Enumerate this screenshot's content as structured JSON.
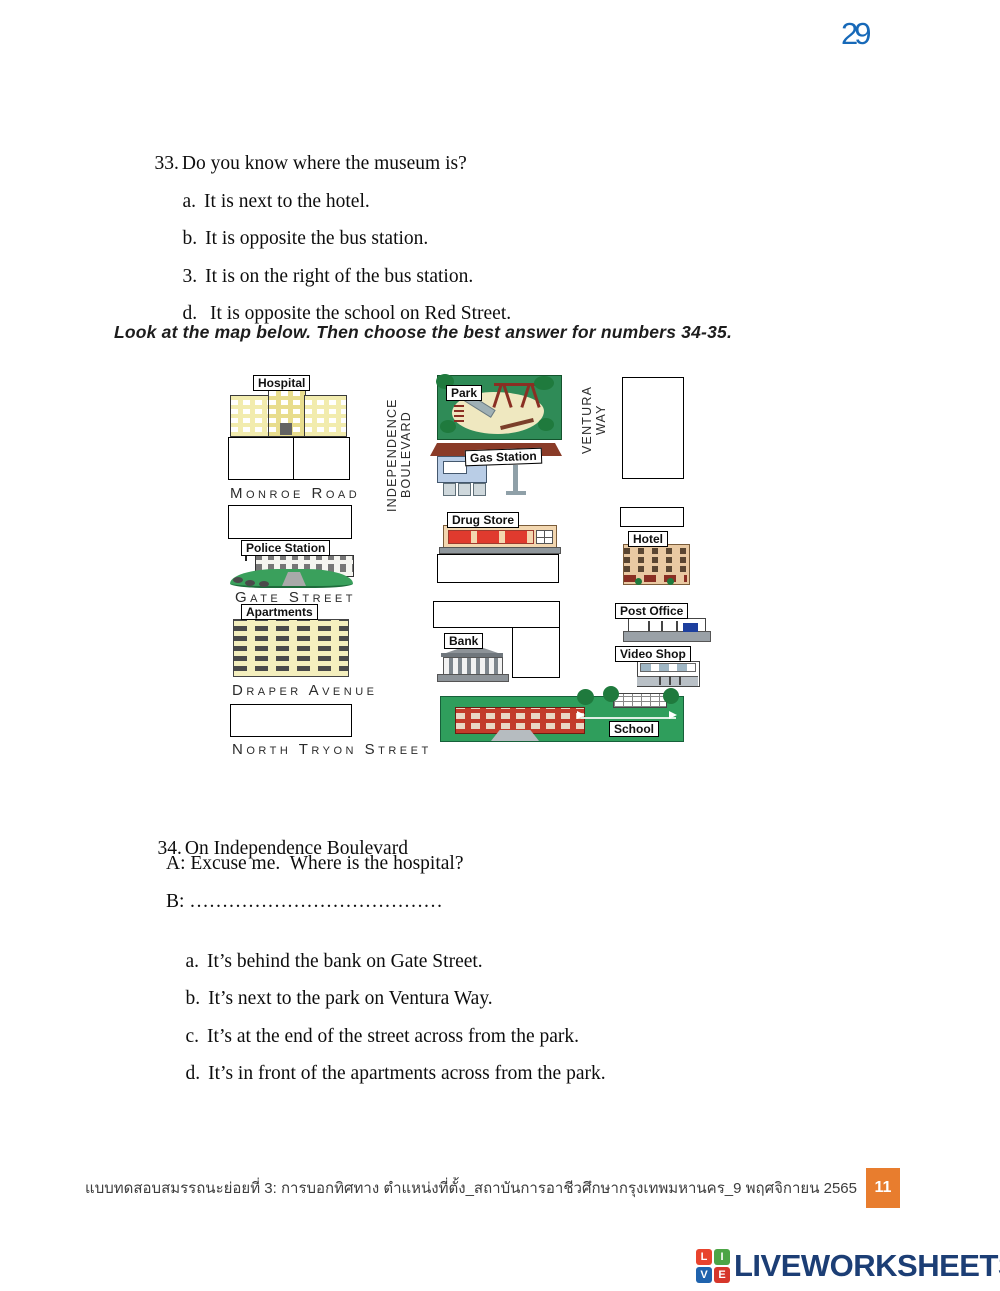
{
  "corner_number": "29",
  "q33": {
    "number": "33.",
    "question": "Do you know where the museum is?",
    "options": [
      {
        "label": "a.",
        "text": "It is next to the hotel."
      },
      {
        "label": "b.",
        "text": "It is opposite the bus station."
      },
      {
        "label": "3.",
        "text": "It is on the right of the bus station."
      },
      {
        "label": "d.",
        "text": " It is opposite the school on Red Street."
      }
    ]
  },
  "instruction": "Look at the map below. Then choose the best answer for numbers 34-35.",
  "map": {
    "buildings": {
      "hospital": "Hospital",
      "park": "Park",
      "gas_station": "Gas Station",
      "drug_store": "Drug Store",
      "police_station": "Police Station",
      "hotel": "Hotel",
      "apartments": "Apartments",
      "bank": "Bank",
      "post_office": "Post Office",
      "video_shop": "Video Shop",
      "school": "School"
    },
    "streets": {
      "monroe": "Monroe Road",
      "independence": "INDEPENDENCE BOULEVARD",
      "ventura": "VENTURA WAY",
      "gate": "Gate Street",
      "draper": "Draper Avenue",
      "north_tryon": "North Tryon Street"
    }
  },
  "q34": {
    "number": "34.",
    "question": "On Independence Boulevard",
    "dialogue_a": "A: Excuse me.  Where is the hospital?",
    "dialogue_b": "B: …………………………………",
    "options": [
      {
        "label": "a.",
        "text": "It’s behind the bank on Gate Street."
      },
      {
        "label": "b.",
        "text": "It’s next to the park on Ventura Way."
      },
      {
        "label": "c.",
        "text": "It’s at the end of the street across from the park."
      },
      {
        "label": "d.",
        "text": "It’s in front of the apartments across from the park."
      }
    ]
  },
  "footer": {
    "text": "แบบทดสอบสมรรถนะย่อยที่ 3: การบอกทิศทาง ตำแหน่งที่ตั้ง_สถาบันการอาชีวศึกษากรุงเทพมหานคร_9 พฤศจิกายน 2565",
    "page_badge": "11",
    "badge_color": "#e87d2e"
  },
  "logo": {
    "text": "LIVEWORKSHEETS",
    "text_color": "#1c3e75",
    "tiles": [
      {
        "letter": "L",
        "color": "#e8432d"
      },
      {
        "letter": "I",
        "color": "#4ca546"
      },
      {
        "letter": "V",
        "color": "#1f63ad"
      },
      {
        "letter": "E",
        "color": "#d6362b"
      }
    ]
  },
  "colors": {
    "corner_number": "#1769b8"
  }
}
